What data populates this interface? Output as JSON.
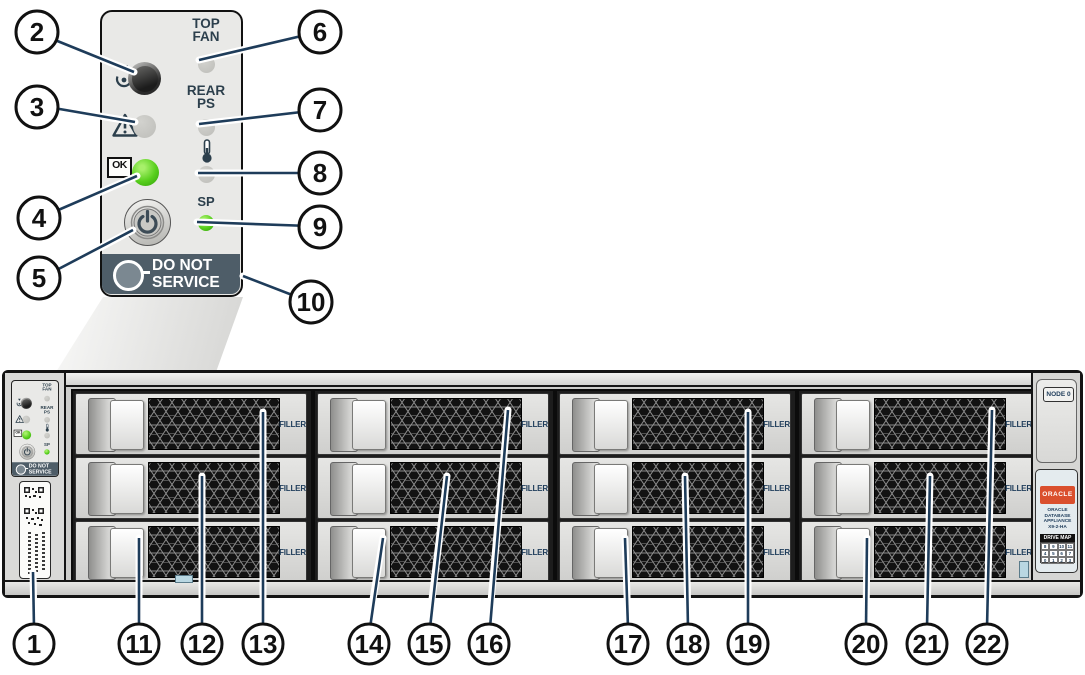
{
  "front_panel": {
    "top_fan": [
      "TOP",
      "FAN"
    ],
    "rear_ps": [
      "REAR",
      "PS"
    ],
    "sp_label": "SP",
    "ok_label": "OK",
    "do_not_service": [
      "DO NOT",
      "SERVICE"
    ]
  },
  "chassis": {
    "node_label": "NODE 0",
    "filler": "FILLER",
    "bays": [
      {
        "label": "FILLER"
      },
      {
        "label": "FILLER"
      },
      {
        "label": "FILLER"
      },
      {
        "label": "FILLER"
      },
      {
        "label": "FILLER"
      },
      {
        "label": "FILLER"
      },
      {
        "label": "FILLER"
      },
      {
        "label": "FILLER"
      },
      {
        "label": "FILLER"
      },
      {
        "label": "FILLER"
      },
      {
        "label": "FILLER"
      },
      {
        "label": "FILLER"
      }
    ],
    "oracle_logo": "ORACLE",
    "product_name": [
      "ORACLE",
      "DATABASE",
      "APPLIANCE",
      "X9-2-HA"
    ],
    "drive_map": {
      "title": "DRIVE MAP",
      "rows": [
        [
          "8",
          "9",
          "10",
          "11"
        ],
        [
          "4",
          "5",
          "6",
          "7"
        ],
        [
          "0",
          "1",
          "2",
          "3"
        ]
      ]
    }
  },
  "callouts": {
    "items": [
      {
        "label": "1"
      },
      {
        "label": "2"
      },
      {
        "label": "3"
      },
      {
        "label": "4"
      },
      {
        "label": "5"
      },
      {
        "label": "6"
      },
      {
        "label": "7"
      },
      {
        "label": "8"
      },
      {
        "label": "9"
      },
      {
        "label": "10"
      },
      {
        "label": "11"
      },
      {
        "label": "12"
      },
      {
        "label": "13"
      },
      {
        "label": "14"
      },
      {
        "label": "15"
      },
      {
        "label": "16"
      },
      {
        "label": "17"
      },
      {
        "label": "18"
      },
      {
        "label": "19"
      },
      {
        "label": "20"
      },
      {
        "label": "21"
      },
      {
        "label": "22"
      }
    ]
  },
  "icons": {
    "locate": "locate-target-icon",
    "fault": "warning-triangle-icon",
    "ok": "ok-box-icon",
    "power": "power-symbol-icon",
    "temperature": "thermometer-icon"
  },
  "colors": {
    "led_green": "#58cf1d",
    "led_off": "#c6c6c2",
    "leader_line": "#1e3c5a",
    "panel_text": "#2c3f4c",
    "do_not_service_bg": "#4e5d68",
    "oracle_red": "#da4f2d",
    "filler_text": "#1e3c5a"
  }
}
